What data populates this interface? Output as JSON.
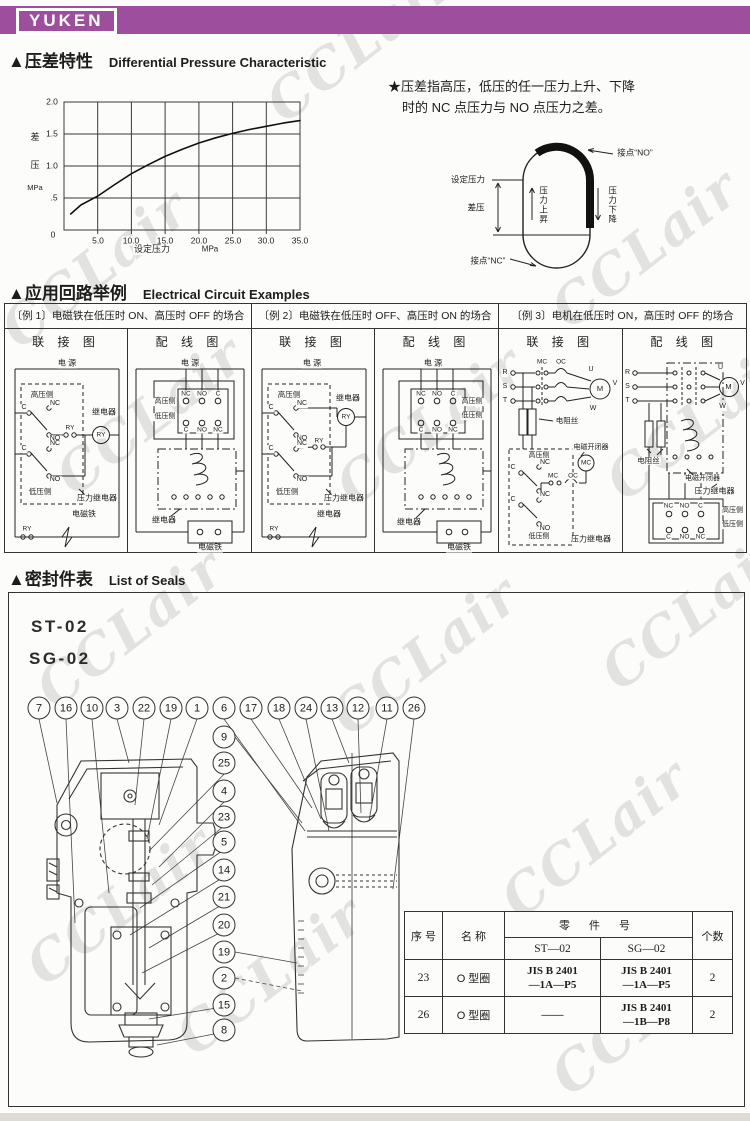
{
  "banner": {
    "logo": "YUKEN",
    "color": "#9d4f9e"
  },
  "watermark": {
    "text": "CCLair",
    "color": "#d3d3d3",
    "positions": [
      {
        "x": 360,
        "y": 42
      },
      {
        "x": 95,
        "y": 268
      },
      {
        "x": 645,
        "y": 248
      },
      {
        "x": 150,
        "y": 415
      },
      {
        "x": 430,
        "y": 425
      },
      {
        "x": 700,
        "y": 420
      },
      {
        "x": 130,
        "y": 628
      },
      {
        "x": 425,
        "y": 655
      },
      {
        "x": 695,
        "y": 610
      },
      {
        "x": 120,
        "y": 905
      },
      {
        "x": 595,
        "y": 838
      },
      {
        "x": 645,
        "y": 1015
      },
      {
        "x": 270,
        "y": 975
      }
    ]
  },
  "sections": {
    "pressure": {
      "title_cn": "▲压差特性",
      "title_en": "Differential Pressure Characteristic",
      "note_line1": "★压差指高压，低压的任一压力上升、下降",
      "note_line2": "时的 NC 点压力与 NO 点压力之差。"
    },
    "circuit": {
      "title_cn": "▲应用回路举例",
      "title_en": "Electrical Circuit Examples"
    },
    "seals": {
      "title_cn": "▲密封件表",
      "title_en": "List of Seals",
      "model1": "ST-02",
      "model2": "SG-02"
    }
  },
  "chart_data": {
    "type": "line",
    "x_label": "设定压力",
    "x_unit": "MPa",
    "y_label": "差压",
    "y_unit": "MPa",
    "x_range": [
      0,
      35
    ],
    "y_range": [
      0,
      2
    ],
    "x_ticks": [
      0,
      5.0,
      10.0,
      15.0,
      20.0,
      25.0,
      30.0,
      35.0
    ],
    "y_ticks": [
      0,
      0.5,
      1.0,
      1.5,
      2.0
    ],
    "grid": true,
    "legend": false,
    "series": [
      {
        "name": "differential-pressure-vs-set-pressure",
        "points": [
          [
            1,
            0.25
          ],
          [
            5,
            0.53
          ],
          [
            10,
            0.88
          ],
          [
            15,
            1.15
          ],
          [
            20,
            1.36
          ],
          [
            25,
            1.51
          ],
          [
            30,
            1.62
          ],
          [
            35,
            1.71
          ]
        ]
      }
    ]
  },
  "chart_labels": [
    {
      "t": "2.0",
      "x": 26,
      "y": 16,
      "fs": 8.5
    },
    {
      "t": "1.5",
      "x": 26,
      "y": 48,
      "fs": 8.5
    },
    {
      "t": "1.0",
      "x": 26,
      "y": 80,
      "fs": 8.5
    },
    {
      "t": ".5",
      "x": 28,
      "y": 112,
      "fs": 8.5
    },
    {
      "t": "0",
      "x": 27,
      "y": 149,
      "fs": 8.5
    },
    {
      "t": "5.0",
      "x": 72,
      "y": 155,
      "fs": 8.5
    },
    {
      "t": "10.0",
      "x": 105,
      "y": 155,
      "fs": 8.5
    },
    {
      "t": "15.0",
      "x": 139,
      "y": 155,
      "fs": 8.5
    },
    {
      "t": "20.0",
      "x": 173,
      "y": 155,
      "fs": 8.5
    },
    {
      "t": "25.0",
      "x": 207,
      "y": 155,
      "fs": 8.5
    },
    {
      "t": "30.0",
      "x": 240,
      "y": 155,
      "fs": 8.5
    },
    {
      "t": "35.0",
      "x": 274,
      "y": 155,
      "fs": 8.5
    },
    {
      "t": "差",
      "x": 9,
      "y": 52,
      "fs": 9
    },
    {
      "t": "压",
      "x": 9,
      "y": 80,
      "fs": 9
    },
    {
      "t": "MPa",
      "x": 9,
      "y": 102,
      "fs": 7.5
    },
    {
      "t": "设定压力",
      "x": 126,
      "y": 164,
      "fs": 9
    },
    {
      "t": "MPa",
      "x": 184,
      "y": 164,
      "fs": 8
    }
  ],
  "loop_labels": [
    {
      "t": "设定压力",
      "x": 38,
      "y": 60,
      "fs": 8.5
    },
    {
      "t": "差压",
      "x": 46,
      "y": 88,
      "fs": 8.5
    },
    {
      "t": "压力上昇",
      "x": 113,
      "y": 85,
      "fs": 8.5,
      "c": "v"
    },
    {
      "t": "压力下降",
      "x": 182,
      "y": 85,
      "fs": 8.5,
      "c": "v"
    },
    {
      "t": "接点“NO”",
      "x": 205,
      "y": 33,
      "fs": 8.5
    },
    {
      "t": "接点“NC”",
      "x": 58,
      "y": 141,
      "fs": 8.5
    }
  ],
  "examples": {
    "e1": {
      "caption": "〔例 1〕电磁铁在低压时 ON、高压时 OFF 的场合",
      "col1": "联 接 图",
      "col2": "配 线 图"
    },
    "e2": {
      "caption": "〔例 2〕电磁铁在低压时 OFF、高压时 ON 的场合",
      "col1": "联 接 图",
      "col2": "配 线 图"
    },
    "e3": {
      "caption": "〔例 3〕电机在低压时 ON，高压时 OFF 的场合",
      "col1": "联 接 图",
      "col2": "配 线 图"
    }
  },
  "panels": {
    "e1c": [
      {
        "t": "电 源",
        "x": 62,
        "y": 13,
        "fs": 8
      },
      {
        "t": "高压侧",
        "x": 37,
        "y": 44,
        "fs": 7.5
      },
      {
        "t": "C",
        "x": 19,
        "y": 57,
        "fs": 7
      },
      {
        "t": "NC",
        "x": 50,
        "y": 53,
        "fs": 7
      },
      {
        "t": "NO",
        "x": 50,
        "y": 88,
        "fs": 7
      },
      {
        "t": "RY",
        "x": 65,
        "y": 77,
        "fs": 6.5
      },
      {
        "t": "继电器",
        "x": 99,
        "y": 62,
        "fs": 8
      },
      {
        "t": "RY",
        "x": 96,
        "y": 84,
        "fs": 6.5
      },
      {
        "t": "C",
        "x": 19,
        "y": 98,
        "fs": 7
      },
      {
        "t": "NC",
        "x": 50,
        "y": 93,
        "fs": 7
      },
      {
        "t": "NO",
        "x": 50,
        "y": 129,
        "fs": 7
      },
      {
        "t": "低压侧",
        "x": 35,
        "y": 141,
        "fs": 7.5
      },
      {
        "t": "压力继电器",
        "x": 92,
        "y": 148,
        "fs": 8
      },
      {
        "t": "电磁铁",
        "x": 79,
        "y": 164,
        "fs": 8
      },
      {
        "t": "RY",
        "x": 22,
        "y": 178,
        "fs": 6.5
      }
    ],
    "e1w": [
      {
        "t": "电 源",
        "x": 62,
        "y": 13,
        "fs": 8
      },
      {
        "t": "NC",
        "x": 58,
        "y": 43,
        "fs": 6.5
      },
      {
        "t": "NO",
        "x": 74,
        "y": 43,
        "fs": 6.5
      },
      {
        "t": "C",
        "x": 90,
        "y": 43,
        "fs": 6.5
      },
      {
        "t": "高压侧",
        "x": 37,
        "y": 51,
        "fs": 7
      },
      {
        "t": "低压侧",
        "x": 37,
        "y": 66,
        "fs": 7
      },
      {
        "t": "C",
        "x": 58,
        "y": 79,
        "fs": 6.5
      },
      {
        "t": "NO",
        "x": 74,
        "y": 79,
        "fs": 6.5
      },
      {
        "t": "NC",
        "x": 90,
        "y": 79,
        "fs": 6.5
      },
      {
        "t": "继电器",
        "x": 36,
        "y": 170,
        "fs": 8
      },
      {
        "t": "电磁铁",
        "x": 82,
        "y": 197,
        "fs": 8
      }
    ],
    "e2c": [
      {
        "t": "电 源",
        "x": 60,
        "y": 13,
        "fs": 8
      },
      {
        "t": "高压侧",
        "x": 37,
        "y": 44,
        "fs": 7.5
      },
      {
        "t": "继电器",
        "x": 96,
        "y": 48,
        "fs": 8
      },
      {
        "t": "C",
        "x": 19,
        "y": 57,
        "fs": 7
      },
      {
        "t": "NC",
        "x": 50,
        "y": 53,
        "fs": 7
      },
      {
        "t": "NO",
        "x": 50,
        "y": 88,
        "fs": 7
      },
      {
        "t": "RY",
        "x": 94,
        "y": 66,
        "fs": 6.5
      },
      {
        "t": "RY",
        "x": 67,
        "y": 90,
        "fs": 6.5
      },
      {
        "t": "C",
        "x": 19,
        "y": 98,
        "fs": 7
      },
      {
        "t": "NC",
        "x": 50,
        "y": 93,
        "fs": 7
      },
      {
        "t": "NO",
        "x": 50,
        "y": 129,
        "fs": 7
      },
      {
        "t": "低压侧",
        "x": 35,
        "y": 141,
        "fs": 7.5
      },
      {
        "t": "压力继电器",
        "x": 92,
        "y": 148,
        "fs": 8
      },
      {
        "t": "继电器",
        "x": 77,
        "y": 164,
        "fs": 8
      },
      {
        "t": "RY",
        "x": 22,
        "y": 178,
        "fs": 6.5
      }
    ],
    "e2w": [
      {
        "t": "电 源",
        "x": 58,
        "y": 13,
        "fs": 8
      },
      {
        "t": "NC",
        "x": 46,
        "y": 43,
        "fs": 6.5
      },
      {
        "t": "NO",
        "x": 62,
        "y": 43,
        "fs": 6.5
      },
      {
        "t": "C",
        "x": 78,
        "y": 43,
        "fs": 6.5
      },
      {
        "t": "高压侧",
        "x": 97,
        "y": 51,
        "fs": 7
      },
      {
        "t": "低压侧",
        "x": 97,
        "y": 65,
        "fs": 7
      },
      {
        "t": "C",
        "x": 46,
        "y": 79,
        "fs": 6.5
      },
      {
        "t": "NO",
        "x": 62,
        "y": 79,
        "fs": 6.5
      },
      {
        "t": "NC",
        "x": 78,
        "y": 79,
        "fs": 6.5
      },
      {
        "t": "继电器",
        "x": 34,
        "y": 172,
        "fs": 8
      },
      {
        "t": "电磁铁",
        "x": 84,
        "y": 197,
        "fs": 8
      }
    ],
    "e3c": [
      {
        "t": "R",
        "x": 6,
        "y": 22,
        "fs": 7
      },
      {
        "t": "S",
        "x": 6,
        "y": 36,
        "fs": 7
      },
      {
        "t": "T",
        "x": 6,
        "y": 50,
        "fs": 7
      },
      {
        "t": "MC",
        "x": 43,
        "y": 11,
        "fs": 6.5
      },
      {
        "t": "OC",
        "x": 62,
        "y": 11,
        "fs": 6.5
      },
      {
        "t": "U",
        "x": 92,
        "y": 19,
        "fs": 7
      },
      {
        "t": "V",
        "x": 116,
        "y": 33,
        "fs": 7
      },
      {
        "t": "W",
        "x": 94,
        "y": 58,
        "fs": 7
      },
      {
        "t": "M",
        "x": 101,
        "y": 38,
        "fs": 7.5
      },
      {
        "t": "电阻丝",
        "x": 68,
        "y": 70,
        "fs": 7.5
      },
      {
        "t": "高压侧",
        "x": 40,
        "y": 105,
        "fs": 7
      },
      {
        "t": "C",
        "x": 14,
        "y": 117,
        "fs": 7
      },
      {
        "t": "NC",
        "x": 46,
        "y": 112,
        "fs": 7
      },
      {
        "t": "NO",
        "x": 46,
        "y": 145,
        "fs": 7
      },
      {
        "t": "电磁开闭器",
        "x": 92,
        "y": 97,
        "fs": 7
      },
      {
        "t": "MC",
        "x": 87,
        "y": 112,
        "fs": 6.5
      },
      {
        "t": "MC",
        "x": 54,
        "y": 125,
        "fs": 6.5
      },
      {
        "t": "OC",
        "x": 74,
        "y": 125,
        "fs": 6.5
      },
      {
        "t": "C",
        "x": 14,
        "y": 149,
        "fs": 7
      },
      {
        "t": "NC",
        "x": 46,
        "y": 144,
        "fs": 7
      },
      {
        "t": "NO",
        "x": 46,
        "y": 178,
        "fs": 7
      },
      {
        "t": "低压侧",
        "x": 40,
        "y": 186,
        "fs": 7
      },
      {
        "t": "压力继电器",
        "x": 92,
        "y": 189,
        "fs": 8
      }
    ],
    "e3w": [
      {
        "t": "R",
        "x": 5,
        "y": 22,
        "fs": 7
      },
      {
        "t": "S",
        "x": 5,
        "y": 36,
        "fs": 7
      },
      {
        "t": "T",
        "x": 5,
        "y": 50,
        "fs": 7
      },
      {
        "t": "U",
        "x": 98,
        "y": 17,
        "fs": 7
      },
      {
        "t": "V",
        "x": 120,
        "y": 33,
        "fs": 7
      },
      {
        "t": "W",
        "x": 100,
        "y": 56,
        "fs": 7
      },
      {
        "t": "M",
        "x": 106,
        "y": 36,
        "fs": 7.5
      },
      {
        "t": "电阻丝",
        "x": 26,
        "y": 110,
        "fs": 7.5
      },
      {
        "t": "电磁开闭器",
        "x": 80,
        "y": 128,
        "fs": 7
      },
      {
        "t": "压力继电器",
        "x": 92,
        "y": 141,
        "fs": 8
      },
      {
        "t": "NC",
        "x": 46,
        "y": 155,
        "fs": 6.5
      },
      {
        "t": "NO",
        "x": 62,
        "y": 155,
        "fs": 6.5
      },
      {
        "t": "C",
        "x": 78,
        "y": 155,
        "fs": 6.5
      },
      {
        "t": "C",
        "x": 46,
        "y": 186,
        "fs": 6.5
      },
      {
        "t": "NO",
        "x": 62,
        "y": 186,
        "fs": 6.5
      },
      {
        "t": "NC",
        "x": 78,
        "y": 186,
        "fs": 6.5
      },
      {
        "t": "高压侧",
        "x": 110,
        "y": 160,
        "fs": 7
      },
      {
        "t": "低压侧",
        "x": 110,
        "y": 174,
        "fs": 7
      }
    ]
  },
  "seal_callouts": {
    "top": [
      {
        "n": "7",
        "x": 30,
        "y": 115
      },
      {
        "n": "16",
        "x": 57,
        "y": 115
      },
      {
        "n": "10",
        "x": 83,
        "y": 115
      },
      {
        "n": "3",
        "x": 108,
        "y": 115
      },
      {
        "n": "22",
        "x": 135,
        "y": 115
      },
      {
        "n": "19",
        "x": 162,
        "y": 115
      },
      {
        "n": "1",
        "x": 188,
        "y": 115
      },
      {
        "n": "6",
        "x": 215,
        "y": 115
      },
      {
        "n": "17",
        "x": 242,
        "y": 115
      },
      {
        "n": "18",
        "x": 270,
        "y": 115
      },
      {
        "n": "24",
        "x": 297,
        "y": 115
      },
      {
        "n": "13",
        "x": 323,
        "y": 115
      },
      {
        "n": "12",
        "x": 349,
        "y": 115
      },
      {
        "n": "11",
        "x": 378,
        "y": 115
      },
      {
        "n": "26",
        "x": 405,
        "y": 115
      }
    ],
    "side": [
      {
        "n": "9",
        "x": 215,
        "y": 144
      },
      {
        "n": "25",
        "x": 215,
        "y": 170
      },
      {
        "n": "4",
        "x": 215,
        "y": 198
      },
      {
        "n": "23",
        "x": 215,
        "y": 224
      },
      {
        "n": "5",
        "x": 215,
        "y": 249
      },
      {
        "n": "14",
        "x": 215,
        "y": 277
      },
      {
        "n": "21",
        "x": 215,
        "y": 304
      },
      {
        "n": "20",
        "x": 215,
        "y": 332
      },
      {
        "n": "19",
        "x": 215,
        "y": 359
      },
      {
        "n": "2",
        "x": 215,
        "y": 385
      },
      {
        "n": "15",
        "x": 215,
        "y": 412
      },
      {
        "n": "8",
        "x": 215,
        "y": 437
      }
    ]
  },
  "parts_table": {
    "col_no": "序  号",
    "col_name": "名  称",
    "col_part": "零 件 号",
    "col_qty": "个数",
    "sub_st": "ST—02",
    "sub_sg": "SG—02",
    "rows": [
      {
        "no": "23",
        "name": "O 型圈",
        "st1": "JIS B 2401",
        "st2": "—1A—P5",
        "sg1": "JIS B 2401",
        "sg2": "—1A—P5",
        "qty": "2"
      },
      {
        "no": "26",
        "name": "O 型圈",
        "st1": "——",
        "st2": "",
        "sg1": "JIS B 2401",
        "sg2": "—1B—P8",
        "qty": "2"
      }
    ]
  }
}
